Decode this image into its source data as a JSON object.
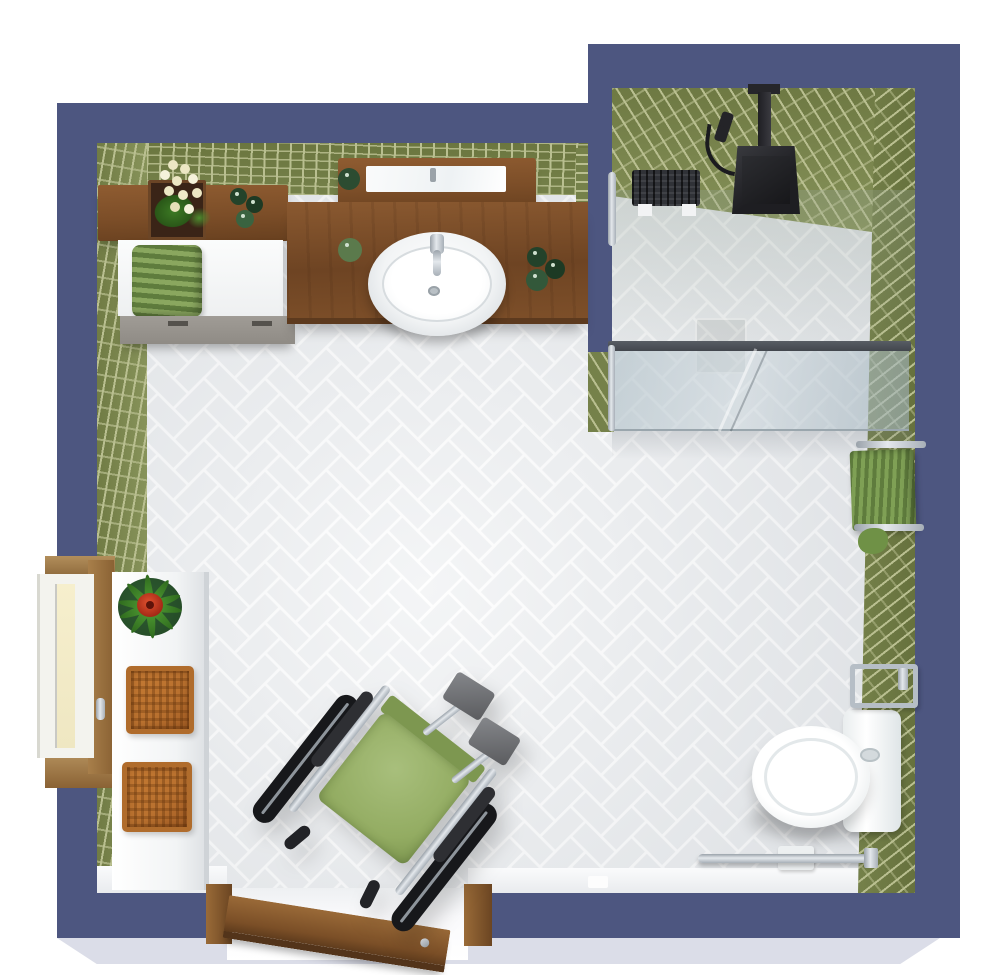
{
  "scene": {
    "kind": "accessible-bathroom-3d-floor-plan",
    "view": "top-down-render"
  },
  "palette": {
    "wall": "#4d5680",
    "wall_dark": "#424b72",
    "slab": "#dbdde8",
    "floor": "#edeff1",
    "floor_grout": "#ffffff",
    "tile": "#75814a",
    "tile_light": "#87935a",
    "tile_grout": "#b9bf90",
    "wood": "#7c4e28",
    "wood_mid": "#8f5c31",
    "wood_light": "#b28e5b",
    "white_fixture": "#f7f8f9",
    "chrome": "#c3c9d0",
    "chrome_dark": "#8f979f",
    "black": "#26262b",
    "glass": "rgba(170,188,197,0.55)",
    "glass_rail": "#42464d",
    "towel": "#8aa75f",
    "towel_dark": "#5f7c3d",
    "basket": "#b9712f",
    "seat": "#93ac62",
    "plant": "#3c7a24",
    "flower_red": "#c8401f",
    "cream": "#ece7c4",
    "foot_gray": "#6e7074",
    "drawer": "#a09c96"
  },
  "objects": {
    "walls": {
      "label": "navy exterior walls"
    },
    "floor": {
      "label": "white herringbone tile floor"
    },
    "vanity": {
      "label": "wood vanity counter with basin"
    },
    "mirror": {
      "label": "wood framed mirror shelf"
    },
    "side_shelf": {
      "label": "wood shelf with orchid and jars"
    },
    "cabinet": {
      "label": "white cabinet with green towel"
    },
    "shower": {
      "label": "walk-in shower with glass partition"
    },
    "shower_head": {
      "label": "black rainfall shower head"
    },
    "shower_bench": {
      "label": "black shower bench"
    },
    "toilet": {
      "label": "white toilet with fold-down grab bar"
    },
    "towel_rack": {
      "label": "green towels on chrome rack"
    },
    "wheelchair": {
      "label": "wheelchair with green seat"
    },
    "window": {
      "label": "wood framed window"
    },
    "window_bench": {
      "label": "white bench with plant and wicker baskets"
    },
    "door": {
      "label": "wood door swung open"
    }
  }
}
